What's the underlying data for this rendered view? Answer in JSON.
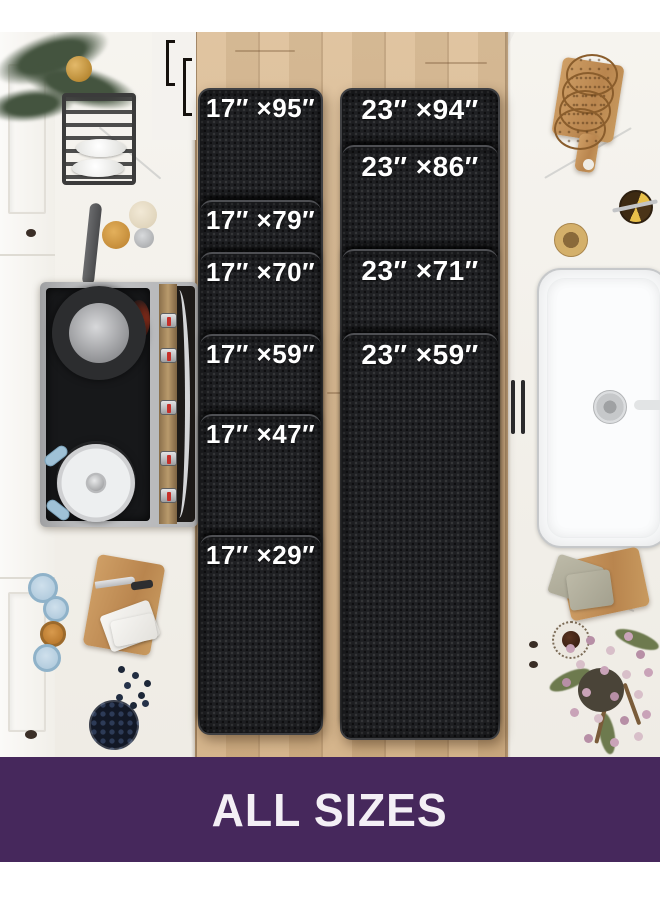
{
  "banner": {
    "label": "ALL SIZES",
    "background": "#46285c",
    "text_color": "#f3eff5"
  },
  "mats": {
    "mat_color": "#1f2023",
    "label_color": "#ffffff",
    "left": {
      "sections": [
        {
          "label": "17″ ×95″"
        },
        {
          "label": "17″ ×79″"
        },
        {
          "label": "17″ ×70″"
        },
        {
          "label": "17″ ×59″"
        },
        {
          "label": "17″ ×47″"
        },
        {
          "label": "17″ ×29″"
        }
      ]
    },
    "right": {
      "sections": [
        {
          "label": "23″ ×94″"
        },
        {
          "label": "23″ ×86″"
        },
        {
          "label": "23″ ×71″"
        },
        {
          "label": "23″ ×59″"
        }
      ]
    }
  },
  "scene": {
    "floor_color": "#d9b98f",
    "counter_color": "#f3f1ec",
    "jar_lid_color": "#a9c5d9"
  }
}
